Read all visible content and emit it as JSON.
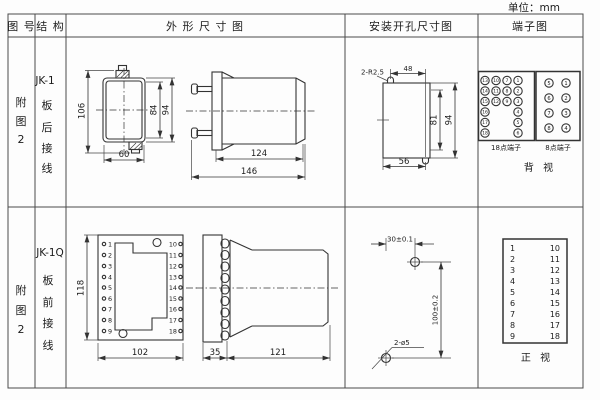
{
  "unit_label": "单位：mm",
  "headers": {
    "figure": "图 号",
    "structure": "结 构",
    "outline": "外 形 尺 寸 图",
    "mounting": "安装开孔尺寸图",
    "terminal": "端子图"
  },
  "row1": {
    "figure_chars": [
      "附",
      "图",
      "2"
    ],
    "model": "JK-1",
    "mount_chars": [
      "板",
      "后",
      "接",
      "线"
    ],
    "dims": {
      "height": "106",
      "inner_height": "84",
      "outer_height": "94",
      "width": "60",
      "body_length": "124",
      "total_length": "146"
    },
    "mounting": {
      "slot_radius": "2-R2.5",
      "slot_span": "48",
      "inner_height": "81",
      "outer_height": "94",
      "bottom_span": "56"
    },
    "t18": {
      "label": "18点端子",
      "numbers": [
        "13",
        "10",
        "7",
        "1",
        "14",
        "11",
        "8",
        "2",
        "15",
        "12",
        "9",
        "3",
        "16",
        "4",
        "17",
        "5",
        "18",
        "6"
      ]
    },
    "t8": {
      "label": "8点端子",
      "left": [
        "5",
        "6",
        "7",
        "8"
      ],
      "right": [
        "1",
        "2",
        "3",
        "4"
      ]
    },
    "view_label": "背 视"
  },
  "row2": {
    "figure_chars": [
      "附",
      "图",
      "2"
    ],
    "model": "JK-1Q",
    "mount_chars": [
      "板",
      "前",
      "接",
      "线"
    ],
    "dims": {
      "height": "118",
      "width": "102",
      "plate_depth": "35",
      "body_length": "121"
    },
    "mounting": {
      "hole_spacing_h": "30±0.1",
      "hole_spacing_v": "100±0.2",
      "hole_label": "2-ø5"
    },
    "terminals_left": [
      "1",
      "2",
      "3",
      "4",
      "5",
      "6",
      "7",
      "8",
      "9"
    ],
    "terminals_right": [
      "10",
      "11",
      "12",
      "13",
      "14",
      "15",
      "16",
      "17",
      "18"
    ],
    "view_label": "正 视"
  }
}
